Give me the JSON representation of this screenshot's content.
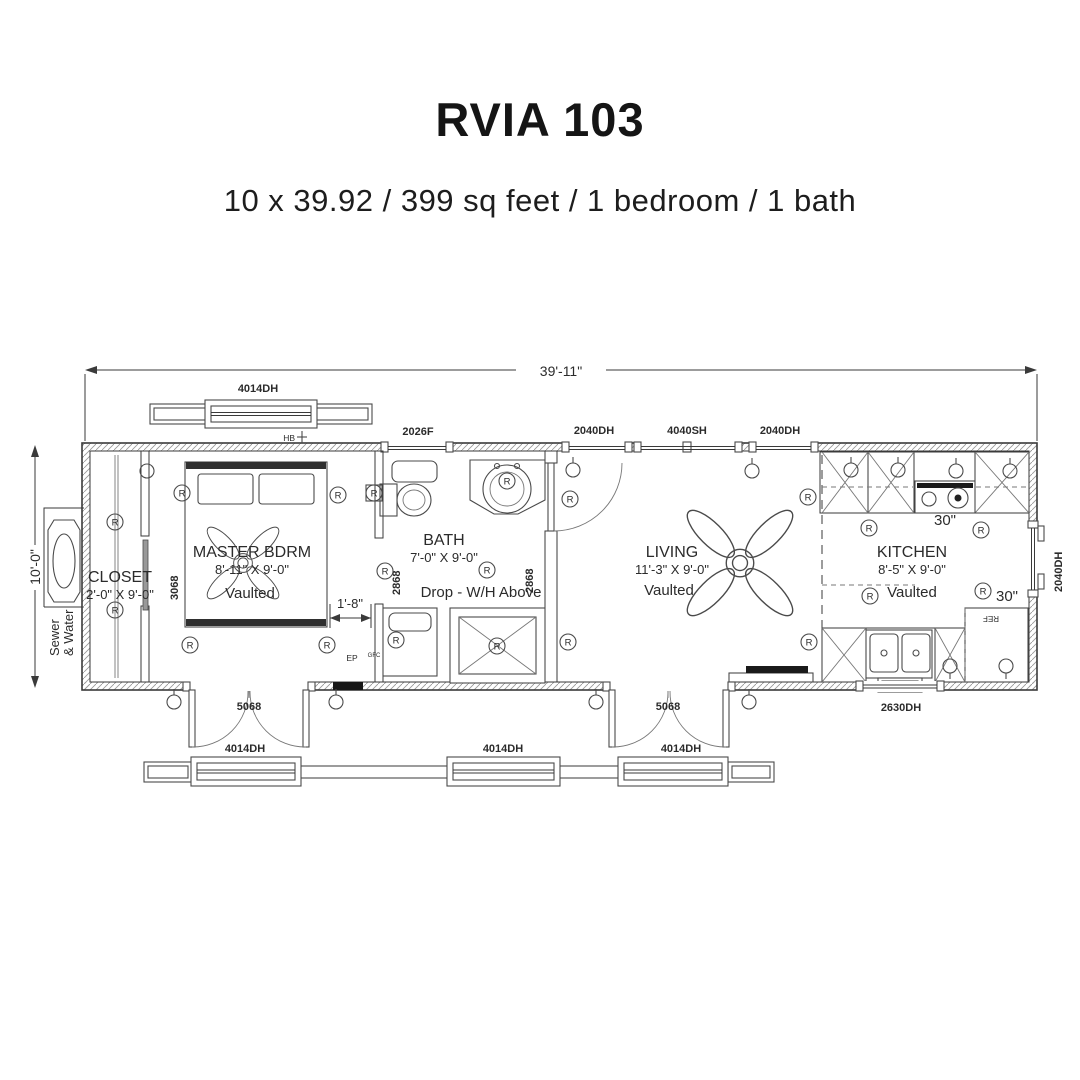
{
  "header": {
    "title": "RVIA 103",
    "subtitle": "10 x 39.92 / 399 sq feet / 1 bedroom / 1 bath"
  },
  "dimensions": {
    "overall_width": "39'-11\"",
    "overall_depth": "10'-0\"",
    "bed_clearance": "1'-8\""
  },
  "rooms": {
    "closet": {
      "name": "CLOSET",
      "size": "2'-0\" X 9'-0\""
    },
    "master": {
      "name": "MASTER BDRM",
      "size": "8'-11\" X 9'-0\"",
      "ceiling": "Vaulted"
    },
    "bath": {
      "name": "BATH",
      "size": "7'-0\" X 9'-0\"",
      "note": "Drop - W/H Above"
    },
    "living": {
      "name": "LIVING",
      "size": "11'-3\" X 9'-0\"",
      "ceiling": "Vaulted"
    },
    "kitchen": {
      "name": "KITCHEN",
      "size": "8'-5\" X 9'-0\"",
      "ceiling": "Vaulted"
    }
  },
  "openings": {
    "top_windows": [
      "4014DH",
      "2026F",
      "2040DH",
      "4040SH",
      "2040DH"
    ],
    "right_window": "2040DH",
    "bottom_window": "2630DH",
    "porch_windows": [
      "4014DH",
      "4014DH",
      "4014DH"
    ],
    "doors": {
      "french1": "5068",
      "french2": "5068",
      "closet": "3068",
      "bath_left": "2868",
      "bath_right": "2868"
    }
  },
  "appliances": {
    "range_width": "30\"",
    "fridge_width": "30\"",
    "fridge": "REF"
  },
  "symbols": {
    "receptacle": "R",
    "hose_bib": "HB",
    "electrical_panel": "EP",
    "gfci": "GFC",
    "utilities_line1": "Sewer",
    "utilities_line2": "& Water"
  }
}
